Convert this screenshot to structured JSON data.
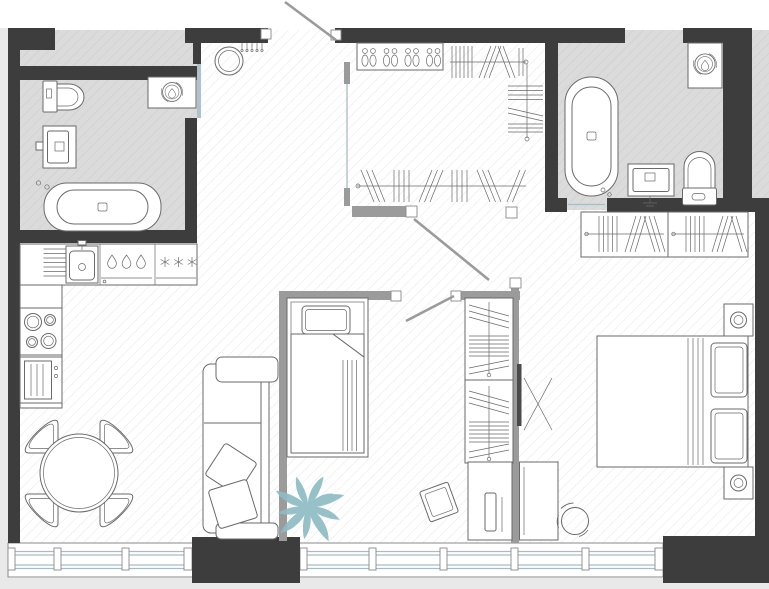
{
  "scene": {
    "kind": "apartment-floor-plan",
    "style": "top-down architectural drawing, monochrome line work with hatched floors",
    "text_visible": false
  },
  "colors": {
    "background": "#ffffff",
    "margin": "#e9e9e9",
    "wall_dark": "#3d3d3d",
    "wall_light": "#9b9b9b",
    "line": "#6a6a6a",
    "bathroom_floor": "#dbdbdb",
    "bathroom_hatch": "#cbcbcb",
    "floor_hatch": "#e6e6e6",
    "glass": "#a8bcc4",
    "door_panel": "#adc2cf",
    "tv_dark": "#4a4a4a",
    "plant": "#8fbcc5"
  },
  "rooms": [
    {
      "name": "bathroom-left",
      "floor": "gray-hatched",
      "fixtures": [
        "toilet",
        "vanity-sink",
        "built-in-bathtub",
        "washing-machine-niche"
      ]
    },
    {
      "name": "entry-hall",
      "floor": "white-hatched",
      "fixtures": [
        "entry-door",
        "round-mirror",
        "coat-hooks",
        "sliding-door-panel"
      ]
    },
    {
      "name": "walk-in-closet",
      "floor": "white-hatched",
      "fixtures": [
        "shoe-rack",
        "clothes-rail-top",
        "clothes-rail-side",
        "clothes-rail-bottom",
        "closet-door"
      ]
    },
    {
      "name": "bathroom-right",
      "floor": "gray-hatched",
      "fixtures": [
        "freestanding-bathtub",
        "washing-machine-niche",
        "vanity-sink",
        "toilet",
        "sliding-door"
      ]
    },
    {
      "name": "kitchen-dining-living",
      "floor": "white-hatched",
      "fixtures": [
        "drainboard",
        "kitchen-sink",
        "faucet",
        "dishwasher",
        "fridge-freezer",
        "cooktop",
        "oven",
        "dining-table",
        "dining-chairs",
        "sofa",
        "sofa-pillows",
        "plant"
      ]
    },
    {
      "name": "kids-room-niche",
      "floor": "white-hatched",
      "fixtures": [
        "single-bed",
        "pillow",
        "folded-blanket",
        "niche-door",
        "wardrobe-two-sections",
        "cabinet-with-drawer",
        "tilted-chair"
      ]
    },
    {
      "name": "bedroom",
      "floor": "white-hatched",
      "fixtures": [
        "wardrobe-two-sections",
        "double-bed",
        "bed-pillows",
        "nightstand-lamp-top",
        "nightstand-lamp-bottom",
        "wall-tv",
        "desk",
        "office-chair"
      ]
    }
  ],
  "openings": {
    "entry_door": "top wall, leaf shown open outward",
    "interior_doors": [
      "closet-door",
      "kids-niche-door",
      "bathroom-right-sliding-door",
      "bathroom-left-sliding-panel"
    ],
    "window_wall": "bottom, continuous glazing with mullions, two dark wall piers"
  },
  "windows": {
    "left_section_mullions": 2,
    "main_section_mullions": 4,
    "dark_piers": 2
  },
  "counts": {
    "dining_chairs": 4,
    "cooktop_burners": 4,
    "dishwasher_drops": 3,
    "fridge_snowflakes": 3,
    "shoe_pairs": 4,
    "bedroom_wardrobe_sections": 2
  }
}
